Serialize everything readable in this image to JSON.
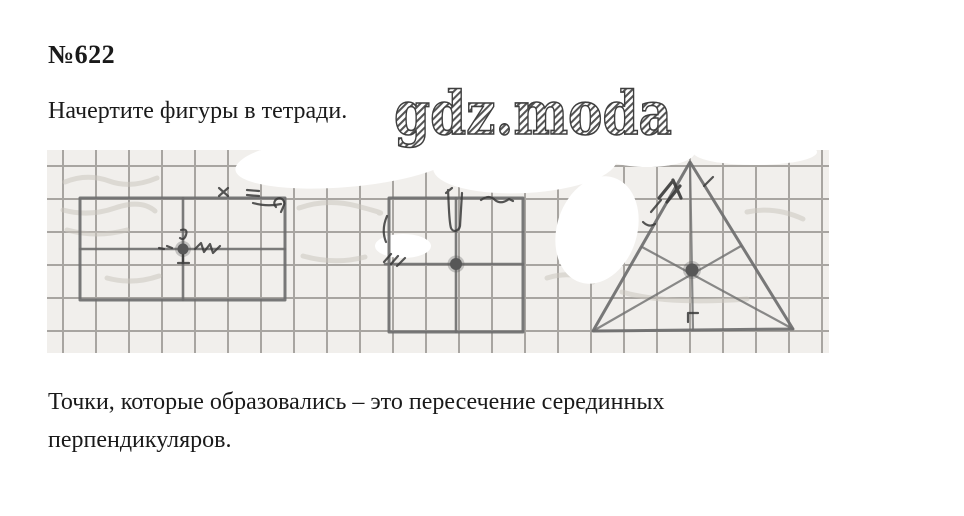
{
  "page": {
    "exercise_number": "№622",
    "instruction": "Начертите фигуры в тетради.",
    "watermark": "gdz.moda",
    "conclusion": "Точки, которые образовались – это пересечение серединных перпендикуляров."
  },
  "diagram": {
    "figures": [
      {
        "name": "rectangle-with-midlines",
        "marked_point": "пересечение серединных перпендикуляров"
      },
      {
        "name": "square-with-midlines",
        "marked_point": "пересечение серединных перпендикуляров"
      },
      {
        "name": "triangle-with-perpendicular-bisectors",
        "marked_point": "пересечение серединных перпендикуляров"
      }
    ]
  },
  "colors": {
    "ink": "#1a1a1a",
    "paper": "#f1efec",
    "grid": "#a8a5a1",
    "stroke": "#6e6e6e",
    "pen": "#383838",
    "dot": "#575757",
    "faint": "#cac6c0",
    "hatch": "#555555",
    "page_bg": "#ffffff"
  }
}
